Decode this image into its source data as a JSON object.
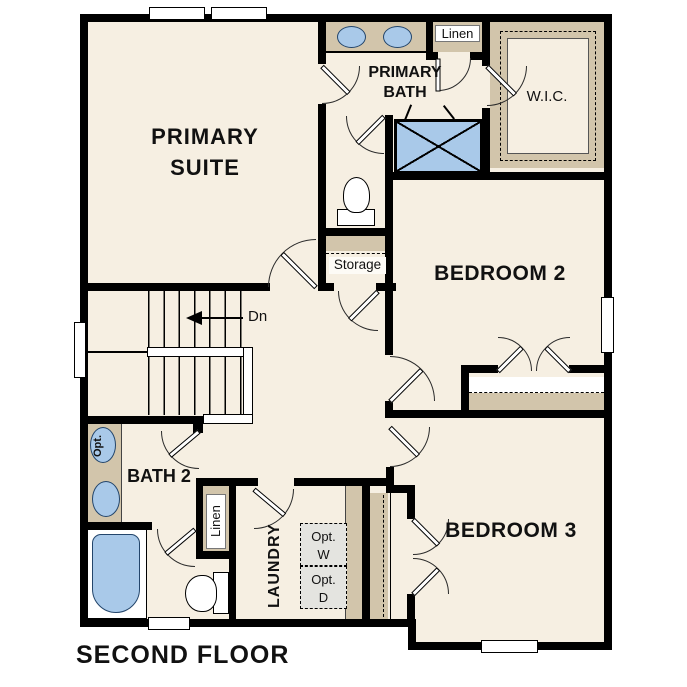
{
  "title": "SECOND FLOOR",
  "colors": {
    "floor": "#f6efe2",
    "cabinetry_tan": "#d2c5ab",
    "fixture_blue": "#a9c9e9",
    "wall_black": "#000000",
    "optional_appliance_gray": "#e4e4e0"
  },
  "rooms": {
    "primary_suite": {
      "line1": "PRIMARY",
      "line2": "SUITE"
    },
    "primary_bath": {
      "line1": "PRIMARY",
      "line2": "BATH"
    },
    "wic": {
      "label": "W.I.C."
    },
    "linen_upper": {
      "label": "Linen"
    },
    "bedroom2": {
      "label": "BEDROOM 2"
    },
    "storage": {
      "label": "Storage"
    },
    "bedroom3": {
      "label": "BEDROOM 3"
    },
    "bath2": {
      "label": "BATH 2"
    },
    "linen_lower": {
      "label": "Linen"
    },
    "laundry": {
      "label": "LAUNDRY"
    }
  },
  "annotations": {
    "stairs_down": "Dn",
    "optional_washer_line1": "Opt.",
    "optional_washer_line2": "W",
    "optional_dryer_line1": "Opt.",
    "optional_dryer_line2": "D",
    "optional_sink": "Opt."
  }
}
